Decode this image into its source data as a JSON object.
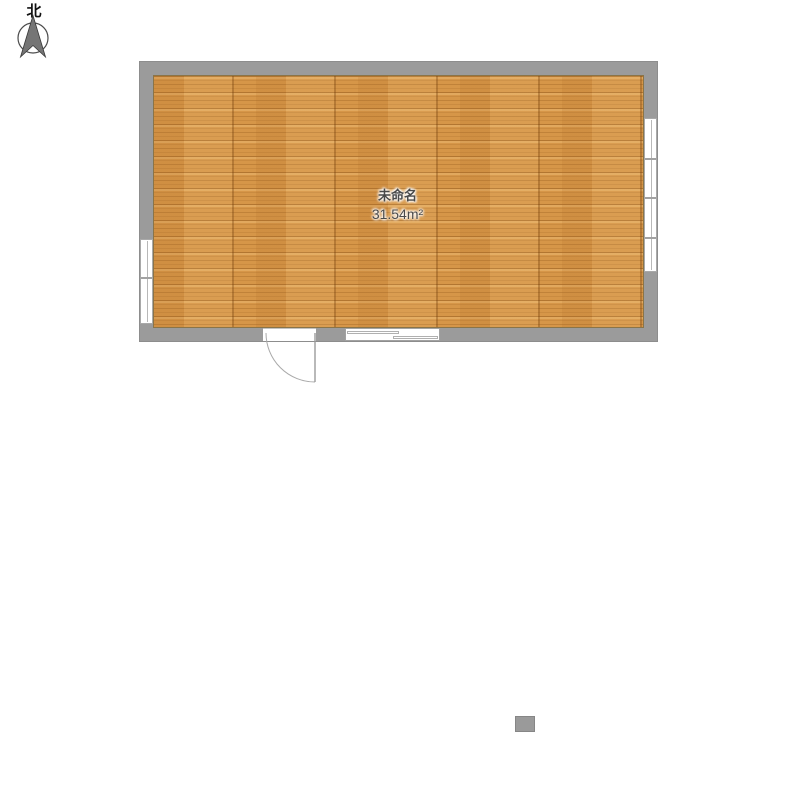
{
  "compass": {
    "label": "北"
  },
  "room": {
    "name": "未命名",
    "area": "31.54m²"
  },
  "colors": {
    "wall": "#9b9b9b",
    "wall_edge": "#8d8d8d",
    "floor_base": "#d69648",
    "floor_grain_dark": "#c07f35",
    "floor_grain_light": "#e8b571",
    "window_fill": "#ffffff",
    "window_line": "#aeaeae",
    "door_arc": "#a9a9a9",
    "label_text": "#4a4a4a",
    "column_fill": "#9a9a9a",
    "compass_arrow": "#757575"
  }
}
